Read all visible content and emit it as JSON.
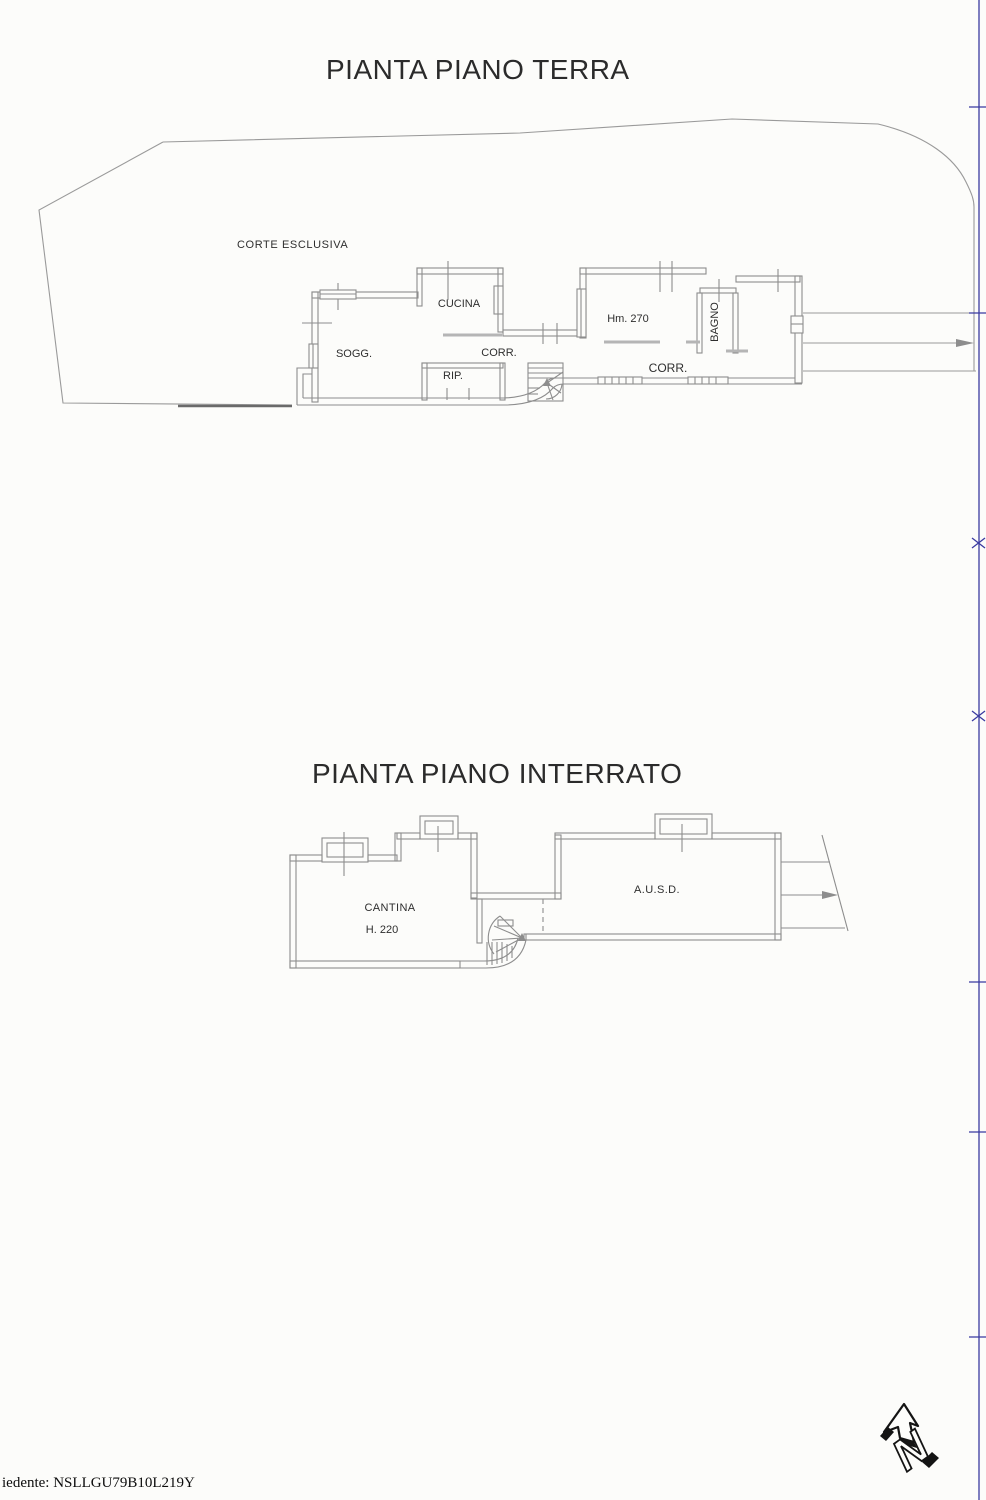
{
  "titles": {
    "ground": "PIANTA PIANO TERRA",
    "basement": "PIANTA PIANO INTERRATO"
  },
  "ground_floor": {
    "labels": {
      "courtyard": "CORTE ESCLUSIVA",
      "living": "SOGG.",
      "kitchen": "CUCINA",
      "corridor1": "CORR.",
      "storage": "RIP.",
      "room_height": "Hm. 270",
      "bathroom": "BAGNO",
      "corridor2": "CORR."
    }
  },
  "basement": {
    "labels": {
      "cellar": "CANTINA",
      "cellar_height": "H. 220",
      "ausd": "A.U.S.D."
    }
  },
  "footer": {
    "applicant": "iedente: NSLLGU79B10L219Y"
  },
  "north": {
    "letter": "N"
  },
  "colors": {
    "wall_line": "#8d8d8d",
    "boundary_line": "#9a9a9a",
    "edge_line": "#3a3aa0",
    "label_text": "#2e2e2e"
  }
}
